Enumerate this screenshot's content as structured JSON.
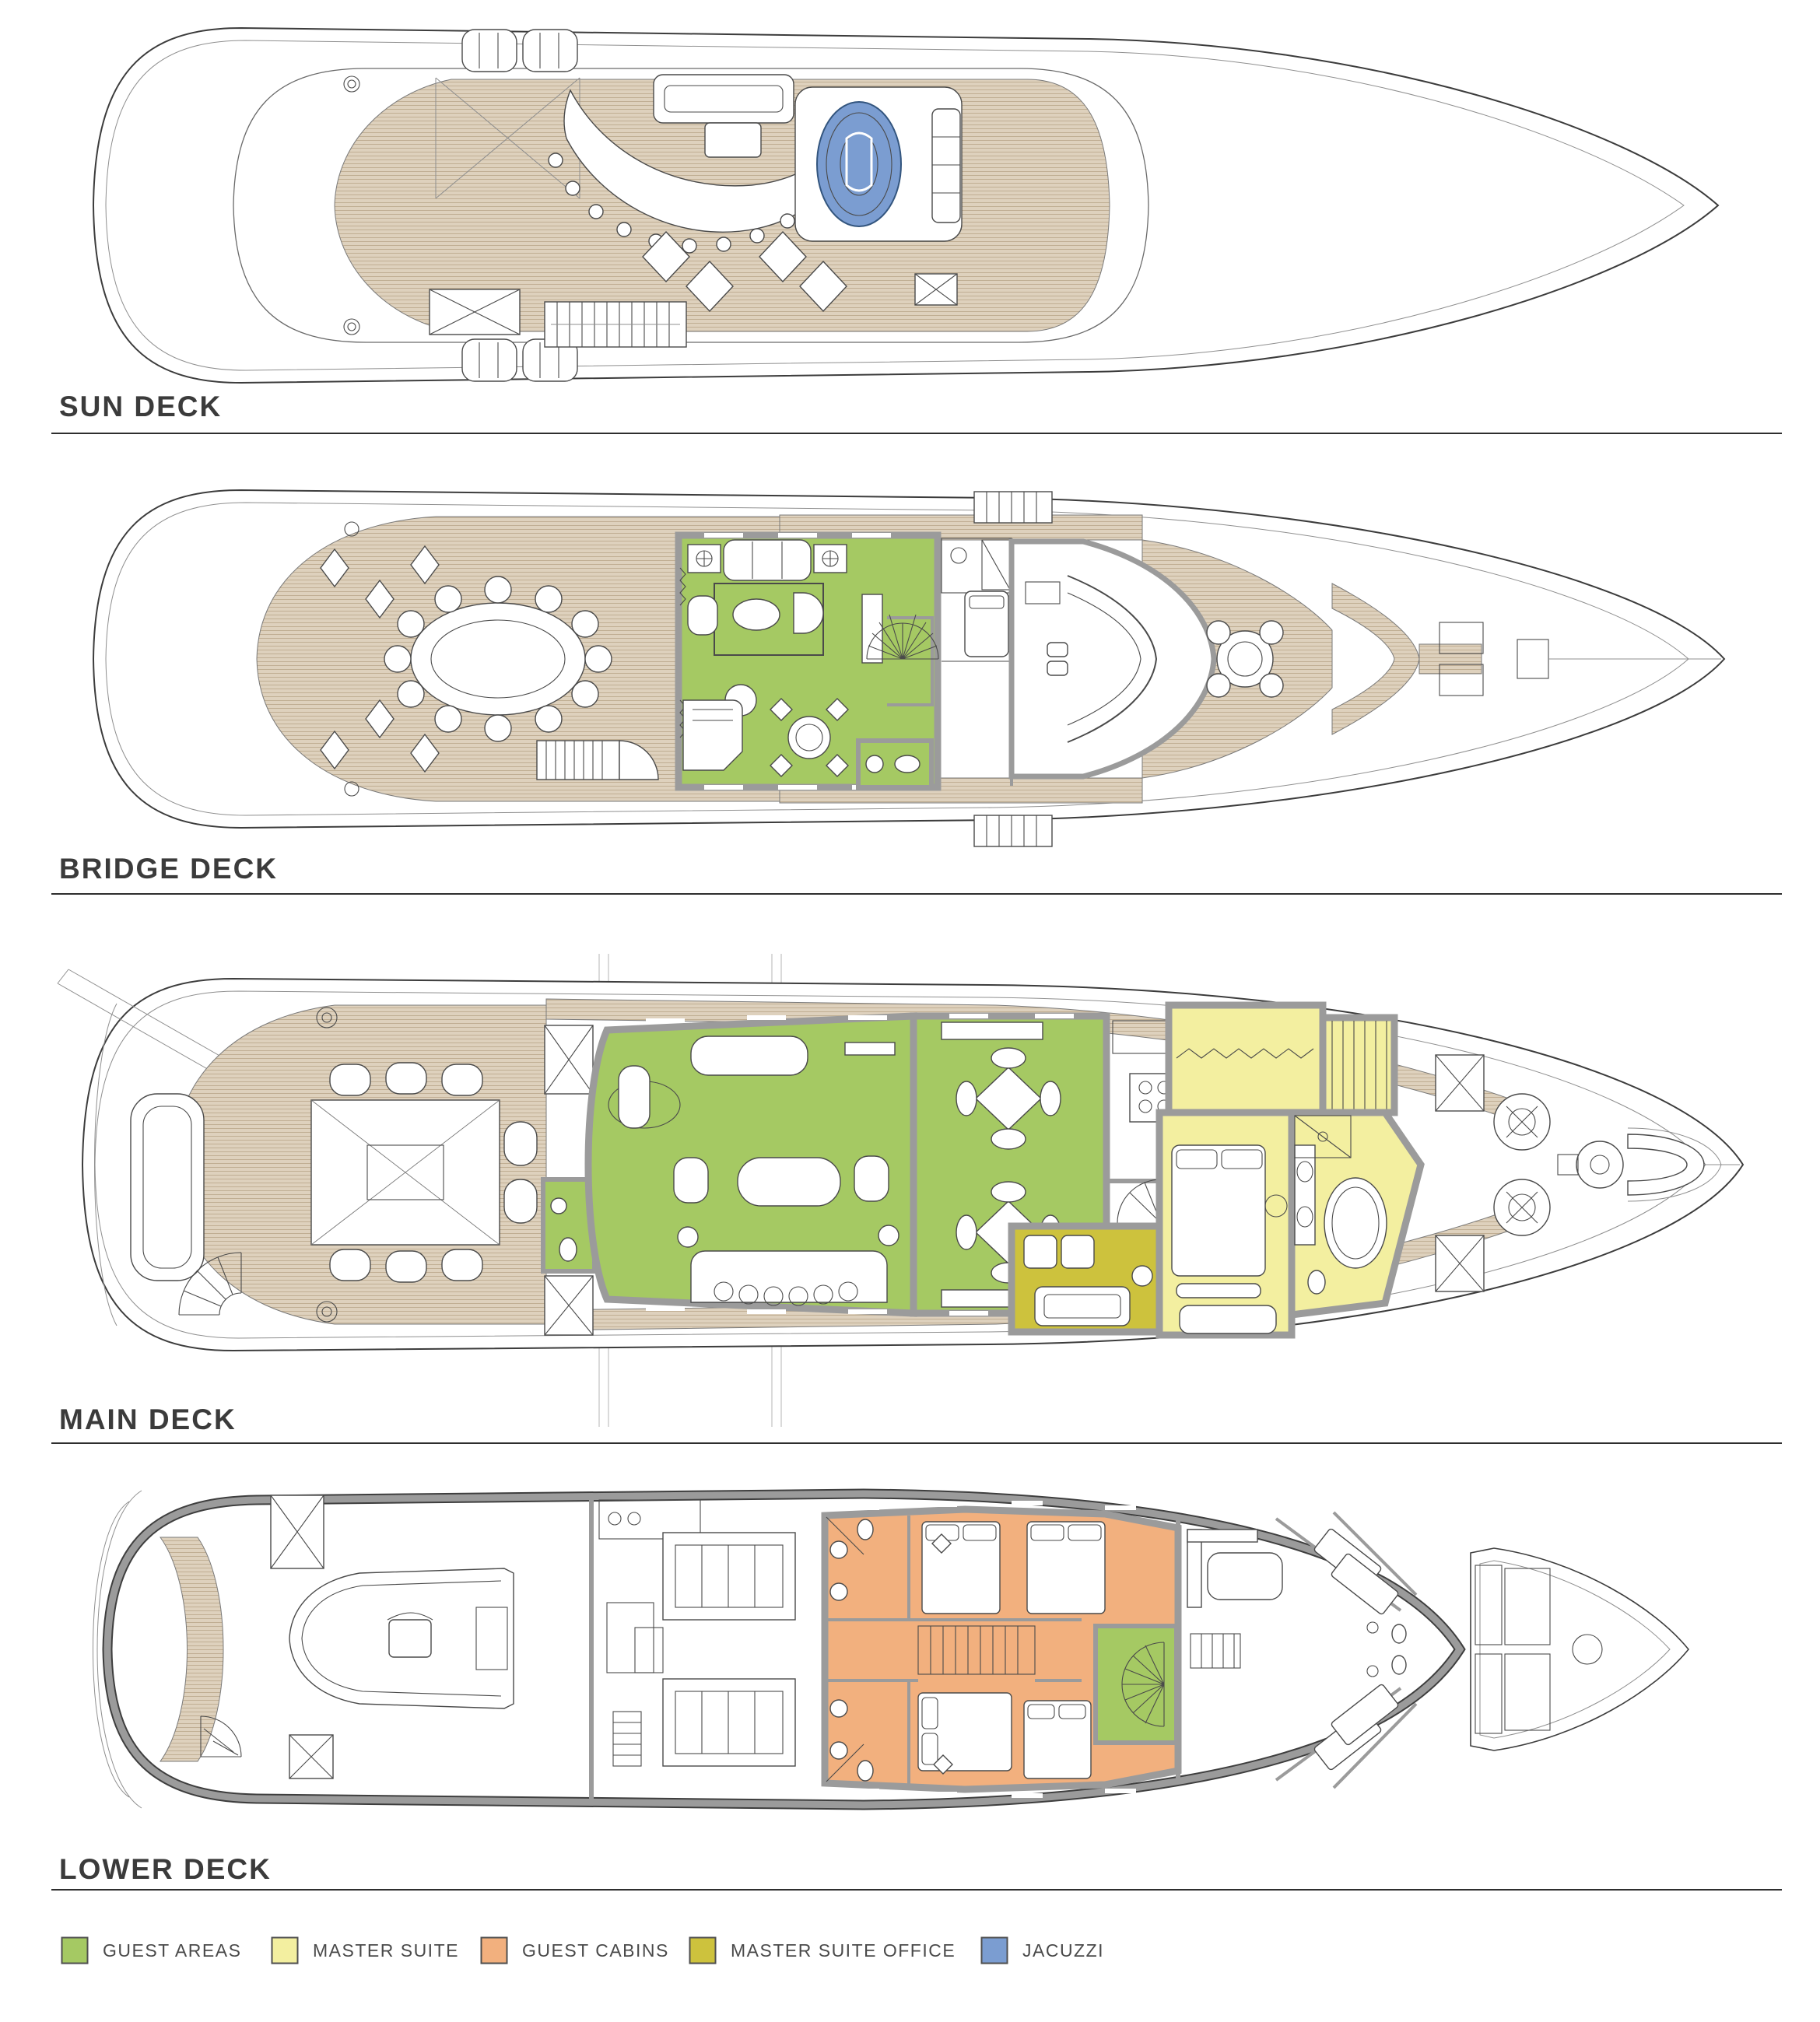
{
  "decks": [
    {
      "name": "sun-deck",
      "label": "SUN DECK"
    },
    {
      "name": "bridge-deck",
      "label": "BRIDGE DECK"
    },
    {
      "name": "main-deck",
      "label": "MAIN DECK"
    },
    {
      "name": "lower-deck",
      "label": "LOWER DECK"
    }
  ],
  "legend": {
    "items": [
      {
        "label": "GUEST AREAS",
        "color": "#a5c963"
      },
      {
        "label": "MASTER SUITE",
        "color": "#f3efa0"
      },
      {
        "label": "GUEST CABINS",
        "color": "#f2b07e"
      },
      {
        "label": "MASTER SUITE OFFICE",
        "color": "#cdc23d"
      },
      {
        "label": "JACUZZI",
        "color": "#7b9dd1"
      }
    ]
  },
  "colors": {
    "guest_areas": "#a5c963",
    "master_suite": "#f3efa0",
    "guest_cabins": "#f2b07e",
    "master_suite_office": "#cdc23d",
    "jacuzzi": "#7b9dd1",
    "deck_teak": "#ded1bd",
    "deck_teak_line": "#c0ae93",
    "wall_gray": "#9b9b9b",
    "outline": "#3c3c3c",
    "label_text": "#3b3b3b",
    "legend_text": "#4a4a4a",
    "rule": "#2e2e2e"
  }
}
